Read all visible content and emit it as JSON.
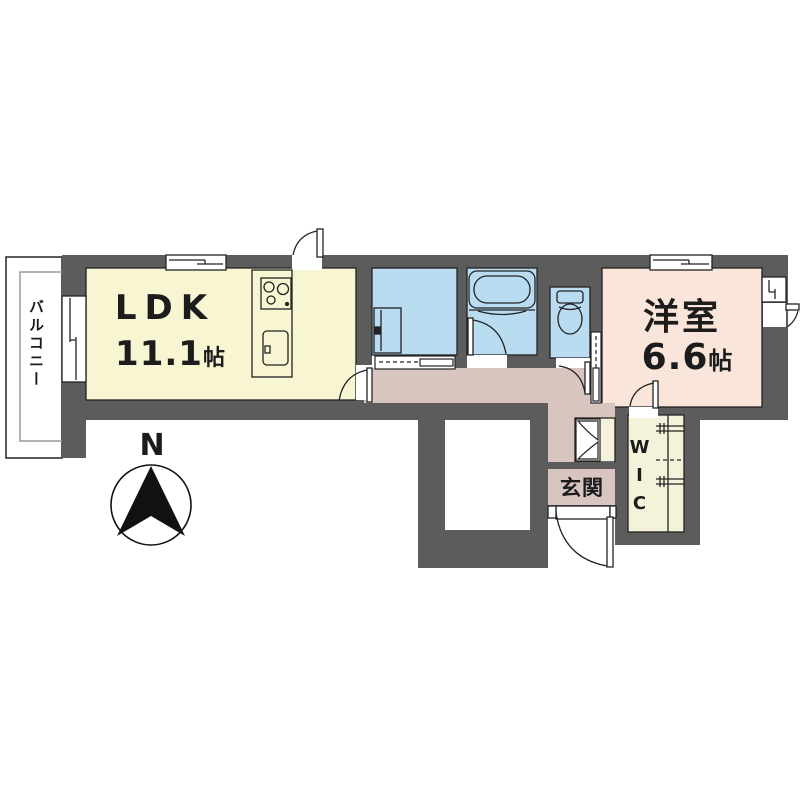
{
  "floor_plan": {
    "rooms": {
      "balcony": {
        "label": "バルコニー"
      },
      "ldk": {
        "label": "LDK",
        "size_value": "11.1",
        "size_unit": "帖"
      },
      "western_room": {
        "label": "洋室",
        "size_value": "6.6",
        "size_unit": "帖"
      },
      "entrance": {
        "label": "玄関"
      },
      "wic": {
        "label": "WIC"
      }
    },
    "compass": {
      "north_label": "N"
    },
    "fixtures": [
      "kitchen-counter",
      "gas-stove",
      "kitchen-sink",
      "washbasin",
      "bathtub",
      "toilet",
      "closet-hanger-pipes"
    ],
    "colors": {
      "wall": "#5c5c5c",
      "ldk_floor": "#f8f6d2",
      "closet_floor": "#f4f2da",
      "wet_area_floor": "#b9dcf1",
      "western_room_floor": "#fae5da",
      "hall_floor": "#d8c5c0",
      "line": "#222222",
      "background": "#ffffff"
    }
  }
}
